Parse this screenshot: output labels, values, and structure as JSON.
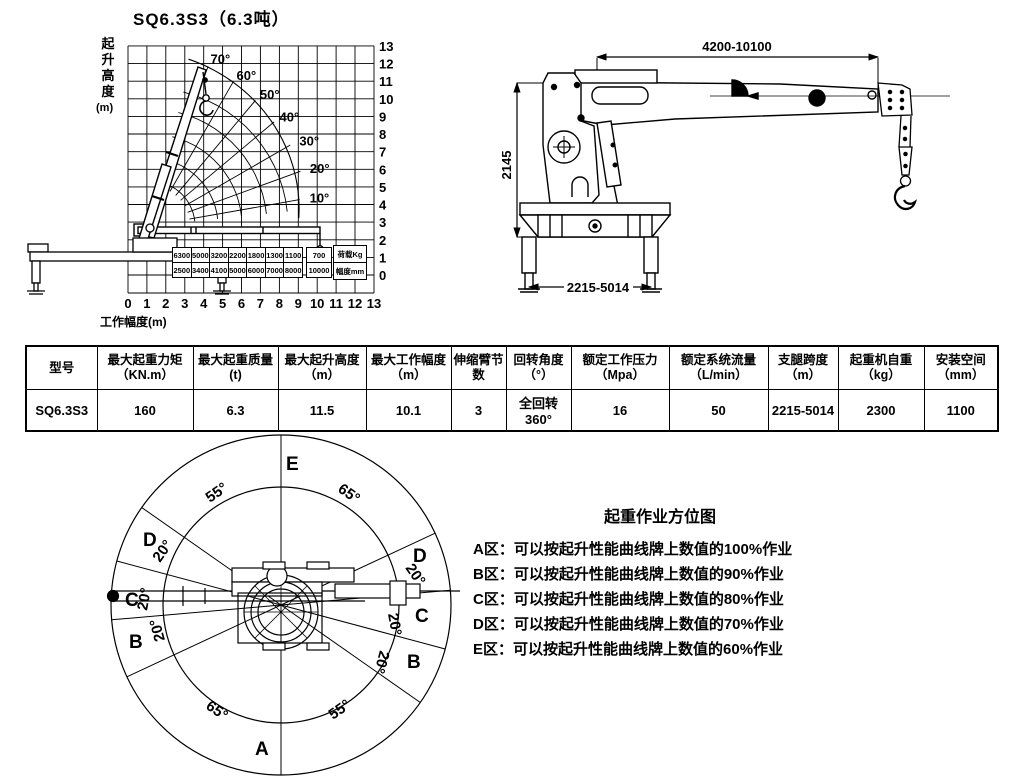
{
  "title": "SQ6.3S3（6.3吨）",
  "load_chart": {
    "y_axis_label": "起升高度",
    "y_axis_unit": "(m)",
    "x_axis_label": "工作幅度(m)",
    "x_ticks": [
      "0",
      "1",
      "2",
      "3",
      "4",
      "5",
      "6",
      "7",
      "8",
      "9",
      "10",
      "11",
      "12",
      "13"
    ],
    "y_ticks": [
      "0",
      "1",
      "2",
      "3",
      "4",
      "5",
      "6",
      "7",
      "8",
      "9",
      "10",
      "11",
      "12",
      "13"
    ],
    "angle_labels": [
      "10°",
      "20°",
      "30°",
      "40°",
      "50°",
      "60°",
      "70°"
    ],
    "load_table": {
      "loads": [
        "6300",
        "5000",
        "3200",
        "2200",
        "1800",
        "1300",
        "1100"
      ],
      "radii": [
        "2500",
        "3400",
        "4100",
        "5000",
        "6000",
        "7000",
        "8000"
      ],
      "ext_load": "700",
      "ext_radius": "10000",
      "load_row_label": "荷载Kg",
      "radius_row_label": "幅度mm"
    }
  },
  "chart_data": {
    "type": "line",
    "title": "SQ6.3S3（6.3吨）",
    "xlabel": "工作幅度(m)",
    "ylabel": "起升高度(m)",
    "xlim": [
      0,
      13
    ],
    "ylim": [
      0,
      13
    ],
    "boom_angles_deg": [
      10,
      20,
      30,
      40,
      50,
      60,
      70
    ],
    "capacity_table": {
      "radius_mm": [
        2500,
        3400,
        4100,
        5000,
        6000,
        7000,
        8000,
        10000
      ],
      "load_kg": [
        6300,
        5000,
        3200,
        2200,
        1800,
        1300,
        1100,
        700
      ]
    }
  },
  "side_view": {
    "dim_length": "4200-10100",
    "dim_height": "2145",
    "dim_span": "2215-5014"
  },
  "spec_table": {
    "headers": [
      "型号",
      "最大起重力矩（KN.m）",
      "最大起重质量(t)",
      "最大起升高度（m）",
      "最大工作幅度（m）",
      "伸缩臂节数",
      "回转角度（°）",
      "额定工作压力（Mpa）",
      "额定系统流量（L/min）",
      "支腿跨度（m）",
      "起重机自重（kg）",
      "安装空间（mm）"
    ],
    "row": [
      "SQ6.3S3",
      "160",
      "6.3",
      "11.5",
      "10.1",
      "3",
      "全回转360°",
      "16",
      "50",
      "2215-5014",
      "2300",
      "1100"
    ]
  },
  "zone_diagram": {
    "zone_top": "E",
    "zone_bottom": "A",
    "zone_left_d": "D",
    "zone_left_c": "C",
    "zone_left_b": "B",
    "zone_right_d": "D",
    "zone_right_c": "C",
    "zone_right_b": "B",
    "angle_top_left": "55°",
    "angle_top_right": "65°",
    "angle_bottom_left": "65°",
    "angle_bottom_right": "55°",
    "angle_small": "20°"
  },
  "legend": {
    "title": "起重作业方位图",
    "items": [
      "A区：可以按起升性能曲线牌上数值的100%作业",
      "B区：可以按起升性能曲线牌上数值的90%作业",
      "C区：可以按起升性能曲线牌上数值的80%作业",
      "D区：可以按起升性能曲线牌上数值的70%作业",
      "E区：可以按起升性能曲线牌上数值的60%作业"
    ]
  }
}
